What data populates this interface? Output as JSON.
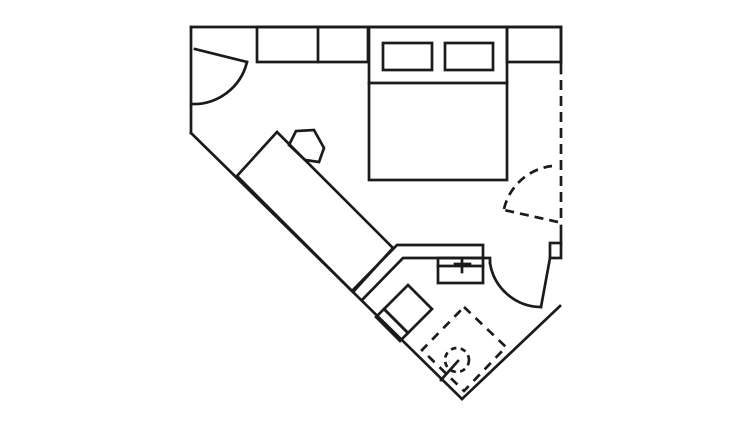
{
  "canvas": {
    "width": 754,
    "height": 435,
    "background": "#ffffff",
    "stroke": "#1b1b1b",
    "stroke_width": 2.7,
    "default_dash": "9 6"
  },
  "floorplan": {
    "description": "single-room floor plan, irregular pentagon footprint with chamfered lower corners",
    "elements": [
      {
        "name": "wall-top",
        "shape": "line",
        "geometry": {
          "x1": 191,
          "y1": 27,
          "x2": 561,
          "y2": 27
        },
        "dashed": false
      },
      {
        "name": "wall-left",
        "shape": "line",
        "geometry": {
          "x1": 191,
          "y1": 27,
          "x2": 191,
          "y2": 133
        },
        "dashed": false
      },
      {
        "name": "wall-bottom-left-diagonal",
        "shape": "line",
        "geometry": {
          "x1": 191,
          "y1": 133,
          "x2": 462,
          "y2": 399
        },
        "dashed": false
      },
      {
        "name": "wall-bottom-right-diagonal",
        "shape": "line",
        "geometry": {
          "x1": 560,
          "y1": 306,
          "x2": 462,
          "y2": 399
        },
        "dashed": false
      },
      {
        "name": "wall-right-upper",
        "shape": "line",
        "geometry": {
          "x1": 561,
          "y1": 27,
          "x2": 561,
          "y2": 73
        },
        "dashed": false
      },
      {
        "name": "wall-right-dashed",
        "shape": "line",
        "geometry": {
          "x1": 561,
          "y1": 80,
          "x2": 561,
          "y2": 222
        },
        "dashed": true,
        "dash": "10 6"
      },
      {
        "name": "wall-right-stub",
        "shape": "line",
        "geometry": {
          "x1": 561,
          "y1": 226,
          "x2": 561,
          "y2": 243
        },
        "dashed": false
      },
      {
        "name": "door-jamb-block",
        "shape": "rect",
        "geometry": {
          "x": 550,
          "y": 243,
          "w": 11,
          "h": 15
        },
        "dashed": false
      },
      {
        "name": "entry-door-leaf",
        "shape": "line",
        "geometry": {
          "x1": 195,
          "y1": 49,
          "x2": 247,
          "y2": 62
        },
        "dashed": false
      },
      {
        "name": "entry-door-swing-arc",
        "shape": "path",
        "geometry": {
          "d": "M 247,62 A 55 55 0 0 1 191,104"
        },
        "dashed": false
      },
      {
        "name": "dashed-door-leaf",
        "shape": "line",
        "geometry": {
          "x1": 558,
          "y1": 222,
          "x2": 504,
          "y2": 210
        },
        "dashed": true,
        "dash": "9 6"
      },
      {
        "name": "dashed-door-swing-arc",
        "shape": "path",
        "geometry": {
          "d": "M 504,209 A 56 56 0 0 1 552,166"
        },
        "dashed": true,
        "dash": "9 6"
      },
      {
        "name": "bathroom-door-leaf",
        "shape": "line",
        "geometry": {
          "x1": 550,
          "y1": 258,
          "x2": 541,
          "y2": 307
        },
        "dashed": false
      },
      {
        "name": "bathroom-door-swing-arc",
        "shape": "path",
        "geometry": {
          "d": "M 490,263 A 52 52 0 0 0 541,307"
        },
        "dashed": false
      },
      {
        "name": "closet-left",
        "shape": "rect",
        "geometry": {
          "x": 257,
          "y": 27,
          "w": 111,
          "h": 35
        },
        "dashed": false
      },
      {
        "name": "closet-left-divider",
        "shape": "line",
        "geometry": {
          "x1": 318,
          "y1": 27,
          "x2": 318,
          "y2": 62
        },
        "dashed": false
      },
      {
        "name": "closet-right",
        "shape": "rect",
        "geometry": {
          "x": 507,
          "y": 27,
          "w": 54,
          "h": 35
        },
        "dashed": false
      },
      {
        "name": "bed",
        "shape": "rect",
        "geometry": {
          "x": 369,
          "y": 27,
          "w": 138,
          "h": 153
        },
        "dashed": false
      },
      {
        "name": "bed-headboard-line",
        "shape": "line",
        "geometry": {
          "x1": 369,
          "y1": 83,
          "x2": 507,
          "y2": 83
        },
        "dashed": false
      },
      {
        "name": "pillow-left",
        "shape": "rect",
        "geometry": {
          "x": 383,
          "y": 43,
          "w": 49,
          "h": 27
        },
        "dashed": false
      },
      {
        "name": "pillow-right",
        "shape": "rect",
        "geometry": {
          "x": 445,
          "y": 43,
          "w": 48,
          "h": 27
        },
        "dashed": false
      },
      {
        "name": "desk",
        "shape": "polygon",
        "geometry": {
          "points": "277,132 393,248 353,292 237,176"
        },
        "dashed": false
      },
      {
        "name": "desk-chair",
        "shape": "polygon",
        "geometry": {
          "points": "289,145 296,131 314,130 324,148 319,162 305,160"
        },
        "dashed": false
      },
      {
        "name": "partition-wall-outer",
        "shape": "path",
        "geometry": {
          "d": "M 353,290 L 397,245 L 483,245 L 483,257"
        },
        "dashed": false
      },
      {
        "name": "partition-wall-inner",
        "shape": "path",
        "geometry": {
          "d": "M 363,299 L 403,258 L 490,258 L 490,263"
        },
        "dashed": false
      },
      {
        "name": "sink",
        "shape": "rect",
        "geometry": {
          "x": 438,
          "y": 258,
          "w": 45,
          "h": 25
        },
        "dashed": false
      },
      {
        "name": "sink-divider-line",
        "shape": "line",
        "geometry": {
          "x1": 438,
          "y1": 266,
          "x2": 483,
          "y2": 266
        },
        "dashed": false
      },
      {
        "name": "faucet-cross-vertical",
        "shape": "line",
        "geometry": {
          "x1": 462,
          "y1": 259,
          "x2": 462,
          "y2": 272
        },
        "dashed": false
      },
      {
        "name": "faucet-cross-horizontal",
        "shape": "line",
        "geometry": {
          "x1": 455,
          "y1": 264,
          "x2": 470,
          "y2": 264
        },
        "dashed": false
      },
      {
        "name": "toilet-bowl",
        "shape": "polygon",
        "geometry": {
          "points": "408,285 432,309 408,333 384,309"
        },
        "dashed": false
      },
      {
        "name": "toilet-tank",
        "shape": "polygon",
        "geometry": {
          "points": "384,309 408,333 400,341 376,317"
        },
        "dashed": false
      },
      {
        "name": "shower-area",
        "shape": "polygon",
        "geometry": {
          "points": "464,307 506,347 464,391 422,350"
        },
        "dashed": true,
        "dash": "9 7"
      },
      {
        "name": "shower-drain-circle",
        "shape": "circle",
        "geometry": {
          "cx": 457,
          "cy": 360,
          "r": 12
        },
        "dashed": true,
        "dash": "5.5 4.5"
      },
      {
        "name": "shower-drain-arm",
        "shape": "line",
        "geometry": {
          "x1": 441,
          "y1": 380,
          "x2": 458,
          "y2": 361
        },
        "dashed": false
      }
    ]
  }
}
